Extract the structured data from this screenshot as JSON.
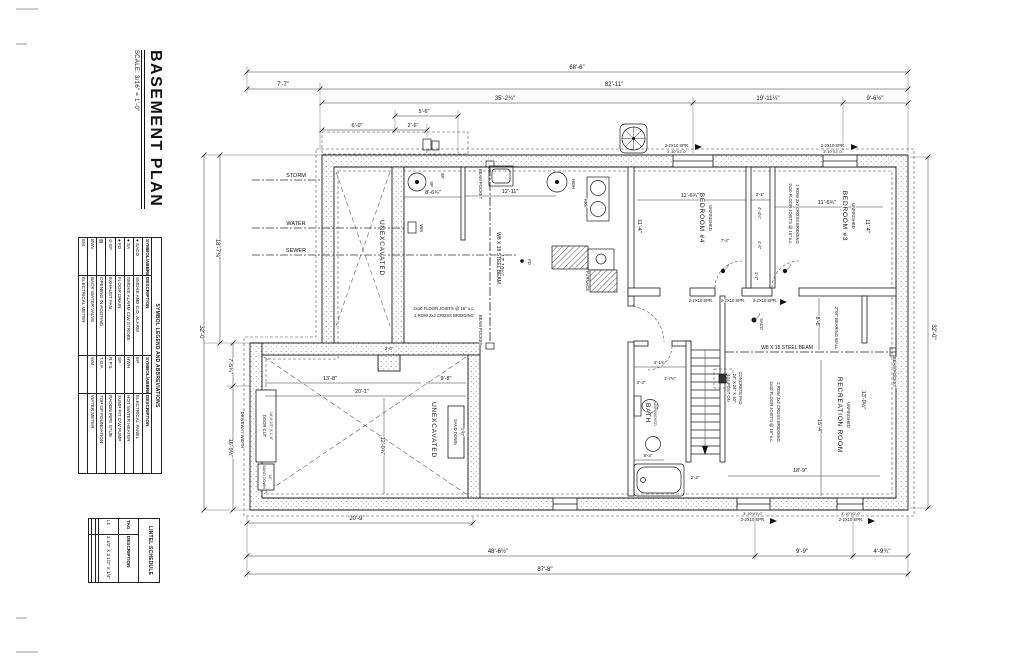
{
  "sheet": {
    "title": "BASEMENT PLAN",
    "scale": "SCALE: 3/16\" = 1'-0\""
  },
  "legend": {
    "title": "SYMBOL LEGEND AND ABBREVIATIONS",
    "h_sym": "SYMBOL/ABBREV.",
    "h_desc": "DESCRIPTION",
    "rows": [
      {
        "s1": "● SACO",
        "d1": "SMOKE AND C.O. ALARM",
        "s2": "EP",
        "d2": "ELECTRICAL PANEL"
      },
      {
        "s1": "● SA",
        "d1": "SMOKE ALARM C/W STROBE",
        "s2": "HWH",
        "d2": "HOT WATER HEATER"
      },
      {
        "s1": "● FD",
        "d1": "FLOOR DRAIN",
        "s2": "SP",
        "d2": "SUMP PIT C/W PUMP"
      },
      {
        "s1": "⊘ EF",
        "d1": "EXHAUST FAN",
        "s2": "R.P.S.",
        "d2": "RADON PIPE STUB"
      },
      {
        "s1": "▨",
        "d1": "OPENING IN FOOTING",
        "s2": "T.O.F.",
        "d2": "TOP OF FOUNDATION"
      },
      {
        "s1": "BWV",
        "d1": "BACK WATER VALVE",
        "s2": "WM",
        "d2": "WATER METER"
      },
      {
        "s1": "EM",
        "d1": "ELECTRICAL METER",
        "s2": "",
        "d2": ""
      }
    ]
  },
  "lintels": {
    "title": "LINTEL SCHEDULE",
    "h_tag": "TAG",
    "h_desc": "DESCRIPTION",
    "rows": [
      {
        "tag": "L1",
        "desc": "3 1/2\" X 3 1/2\" X 1/4\""
      },
      {
        "tag": "",
        "desc": ""
      },
      {
        "tag": "",
        "desc": ""
      },
      {
        "tag": "",
        "desc": ""
      }
    ]
  },
  "rooms": {
    "unexcavated": "UNEXCAVATED",
    "bedroom4": "BEDROOM #4",
    "bedroom3": "BEDROOM #3",
    "recreation": "RECREATION ROOM",
    "bath": "BATH",
    "unfinished": "UNFINISHED"
  },
  "fixtures": {
    "sp": "SP",
    "ef": "EF",
    "hwh": "HWH",
    "hrv": "HRV",
    "wm": "WM",
    "fd": "FD",
    "furnace": "FURNACE",
    "saco": "SACO"
  },
  "utilities": {
    "storm": "STORM",
    "water": "WATER",
    "sewer": "SEWER"
  },
  "notes": {
    "beam": "W8 X 18 STEEL BEAM",
    "beam_pocket": "BEAM POCKET",
    "joists": "2x10 FLOOR JOISTS @ 16\" o.c.",
    "bridging1": "1 ROW 2x2 CROSS BRIDGING",
    "bridging2": "2 ROW 2x2 CROSS BRIDGING",
    "post1": "4X4 POST ON",
    "post2": "24\" X 24\" X 10\"",
    "post3": "CONCRETE PAD",
    "bearing": "2\"X6\" BEARING WALL",
    "lintel": "2-2X10 SPR.",
    "win_size": "3'-10\"X2'-0\"",
    "door_cut": "DOOR CUT",
    "door_cut_size": "16'-6 1/2\" X 1'-6\"",
    "sand_down": "SAND DOWN",
    "sand16": "16\"",
    "sand10": "1'-0\"",
    "driveway": "DRIVEWAY WIDTH"
  },
  "dims": {
    "top": [
      "68'-6\"",
      "7'-7\"",
      "82'-11\"",
      "35'-2¾\"",
      "19'-11½\"",
      "9'-6½\"",
      "5'-6\"",
      "6'-0\"",
      "2'-6\""
    ],
    "bottom": [
      "20'-9\"",
      "48'-6½\"",
      "9'-9\"",
      "4'-9¾\"",
      "87'-8\""
    ],
    "right": "32'-0\"",
    "left": [
      "32'-0\"",
      "18'-7¾\"",
      "7'-5¾\"",
      "16'-9½\""
    ],
    "inner": [
      "8'-6¾\"",
      "12'-11\"",
      "17'-10¼\"",
      "11'-6¾\"",
      "2'-1\"",
      "11'-6¾\"",
      "11'-4\"",
      "11'-4\"",
      "4'-4½\"",
      "4'-4\"",
      "1'-2\"",
      "7'-4\"",
      "4'-1¾\"",
      "1'-7¾\"",
      "3'-3\"",
      "5'-2\"",
      "2'-2\"",
      "13'-8\"",
      "9'-8\"",
      "20'-1\"",
      "12'-0¾\"",
      "2'-6\"",
      "15'-4\"",
      "13'-0½\"",
      "18'-9\"",
      "8'-6\""
    ]
  }
}
